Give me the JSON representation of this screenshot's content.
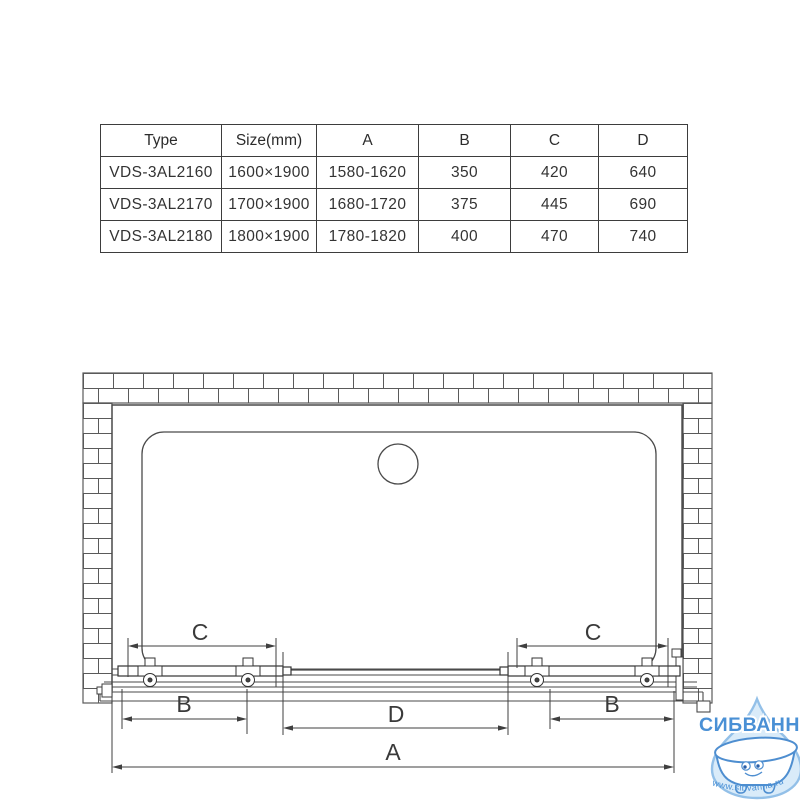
{
  "spec_table": {
    "headers": [
      "Type",
      "Size(mm)",
      "A",
      "B",
      "C",
      "D"
    ],
    "rows": [
      [
        "VDS-3AL2160",
        "1600×1900",
        "1580-1620",
        "350",
        "420",
        "640"
      ],
      [
        "VDS-3AL2170",
        "1700×1900",
        "1680-1720",
        "375",
        "445",
        "690"
      ],
      [
        "VDS-3AL2180",
        "1800×1900",
        "1780-1820",
        "400",
        "470",
        "740"
      ]
    ]
  },
  "drawing": {
    "description": "Top view installation diagram of sliding shower door between brick walls",
    "dim_labels": {
      "a": "A",
      "b": "B",
      "c": "C",
      "d": "D"
    },
    "line_color": "#4a4a4a"
  },
  "logo": {
    "brand": "СИБВАННА",
    "url": "www.sibvanna.ru",
    "brand_color": "#4a90d5",
    "drop_fill": "#d9ebf9",
    "drop_stroke": "#93c0e8",
    "tub_stroke": "#4e8ed0"
  }
}
